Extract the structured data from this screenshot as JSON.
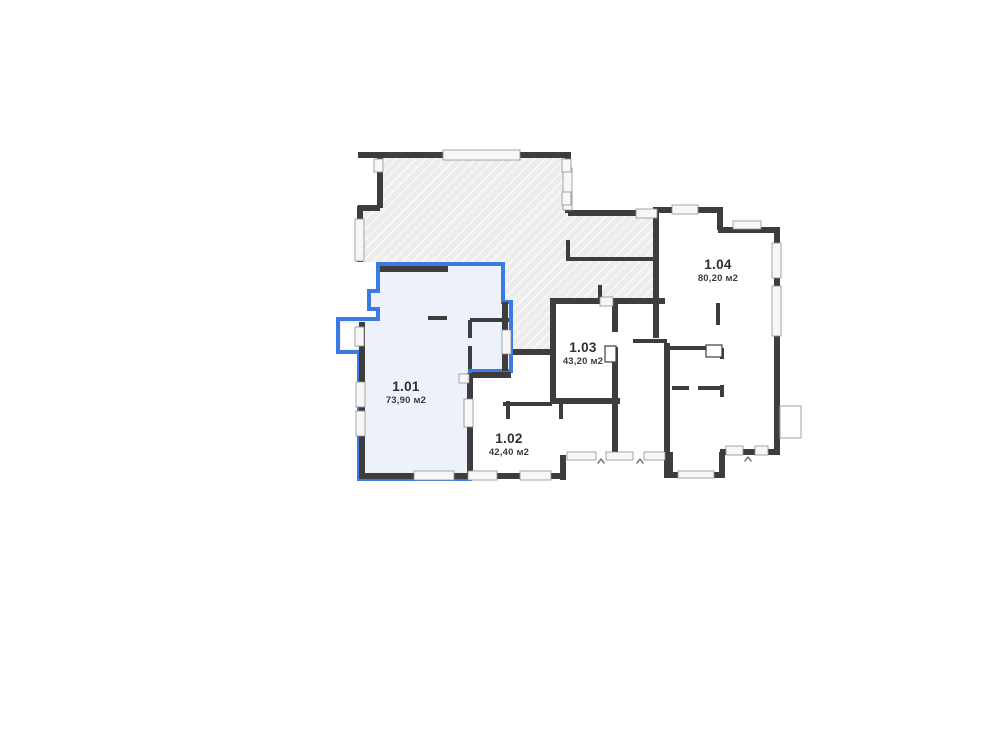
{
  "plan": {
    "title": "floor-plan-level-1",
    "units": [
      {
        "id": "1.01",
        "area": "73,90 м2",
        "highlighted": true
      },
      {
        "id": "1.02",
        "area": "42,40 м2",
        "highlighted": false
      },
      {
        "id": "1.03",
        "area": "43,20 м2",
        "highlighted": false
      },
      {
        "id": "1.04",
        "area": "80,20 м2",
        "highlighted": false
      }
    ],
    "colors": {
      "accent": "#3b7ae4",
      "accent_fill": "#edf1fa",
      "wall": "#3d3d3d",
      "hatch_fill": "#ededed",
      "window": "#f7f7f7"
    }
  }
}
